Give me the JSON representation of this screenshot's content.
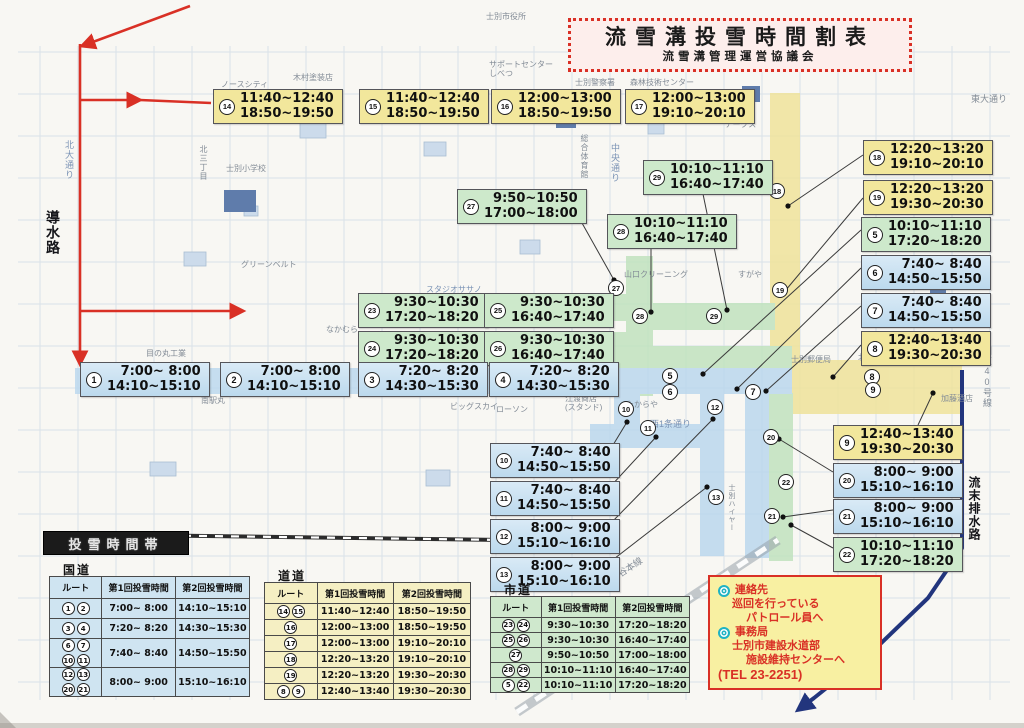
{
  "title": {
    "main": "流雪溝投雪時間割表",
    "sub": "流雪溝管理運営協議会"
  },
  "section_header": "投雪時間帯",
  "colors": {
    "yellow": "#f2e79c",
    "blue": "#bcd9ed",
    "green": "#cde9cb",
    "red_route": "#d93025",
    "river": "#22357d"
  },
  "time_labels": [
    {
      "num": 14,
      "color": "yellow",
      "x": 213,
      "y": 89,
      "t1": "11:40~12:40",
      "t2": "18:50~19:50"
    },
    {
      "num": 15,
      "color": "yellow",
      "x": 359,
      "y": 89,
      "t1": "11:40~12:40",
      "t2": "18:50~19:50"
    },
    {
      "num": 16,
      "color": "yellow",
      "x": 491,
      "y": 89,
      "t1": "12:00~13:00",
      "t2": "18:50~19:50"
    },
    {
      "num": 17,
      "color": "yellow",
      "x": 625,
      "y": 89,
      "t1": "12:00~13:00",
      "t2": "19:10~20:10"
    },
    {
      "num": 29,
      "color": "green",
      "x": 643,
      "y": 160,
      "t1": "10:10~11:10",
      "t2": "16:40~17:40"
    },
    {
      "num": 27,
      "color": "green",
      "x": 457,
      "y": 189,
      "t1": "9:50~10:50",
      "t2": "17:00~18:00"
    },
    {
      "num": 28,
      "color": "green",
      "x": 607,
      "y": 214,
      "t1": "10:10~11:10",
      "t2": "16:40~17:40"
    },
    {
      "num": 18,
      "color": "yellow",
      "x": 863,
      "y": 140,
      "t1": "12:20~13:20",
      "t2": "19:10~20:10"
    },
    {
      "num": 19,
      "color": "yellow",
      "x": 863,
      "y": 180,
      "t1": "12:20~13:20",
      "t2": "19:30~20:30"
    },
    {
      "num": 5,
      "color": "green",
      "x": 861,
      "y": 217,
      "t1": "10:10~11:10",
      "t2": "17:20~18:20"
    },
    {
      "num": 6,
      "color": "blue",
      "x": 861,
      "y": 255,
      "t1": "7:40~ 8:40",
      "t2": "14:50~15:50"
    },
    {
      "num": 7,
      "color": "blue",
      "x": 861,
      "y": 293,
      "t1": "7:40~ 8:40",
      "t2": "14:50~15:50"
    },
    {
      "num": 8,
      "color": "yellow",
      "x": 861,
      "y": 331,
      "t1": "12:40~13:40",
      "t2": "19:30~20:30"
    },
    {
      "num": 23,
      "color": "green",
      "x": 358,
      "y": 293,
      "t1": "9:30~10:30",
      "t2": "17:20~18:20"
    },
    {
      "num": 25,
      "color": "green",
      "x": 484,
      "y": 293,
      "t1": "9:30~10:30",
      "t2": "16:40~17:40"
    },
    {
      "num": 24,
      "color": "green",
      "x": 358,
      "y": 331,
      "t1": "9:30~10:30",
      "t2": "17:20~18:20"
    },
    {
      "num": 26,
      "color": "green",
      "x": 484,
      "y": 331,
      "t1": "9:30~10:30",
      "t2": "16:40~17:40"
    },
    {
      "num": 1,
      "color": "blue",
      "x": 80,
      "y": 362,
      "t1": "7:00~ 8:00",
      "t2": "14:10~15:10"
    },
    {
      "num": 2,
      "color": "blue",
      "x": 220,
      "y": 362,
      "t1": "7:00~ 8:00",
      "t2": "14:10~15:10"
    },
    {
      "num": 3,
      "color": "blue",
      "x": 358,
      "y": 362,
      "t1": "7:20~ 8:20",
      "t2": "14:30~15:30"
    },
    {
      "num": 4,
      "color": "blue",
      "x": 489,
      "y": 362,
      "t1": "7:20~ 8:20",
      "t2": "14:30~15:30"
    },
    {
      "num": 10,
      "color": "blue",
      "x": 490,
      "y": 443,
      "t1": "7:40~ 8:40",
      "t2": "14:50~15:50"
    },
    {
      "num": 11,
      "color": "blue",
      "x": 490,
      "y": 481,
      "t1": "7:40~ 8:40",
      "t2": "14:50~15:50"
    },
    {
      "num": 12,
      "color": "blue",
      "x": 490,
      "y": 519,
      "t1": "8:00~ 9:00",
      "t2": "15:10~16:10"
    },
    {
      "num": 13,
      "color": "blue",
      "x": 490,
      "y": 557,
      "t1": "8:00~ 9:00",
      "t2": "15:10~16:10"
    },
    {
      "num": 9,
      "color": "yellow",
      "x": 833,
      "y": 425,
      "t1": "12:40~13:40",
      "t2": "19:30~20:30"
    },
    {
      "num": 20,
      "color": "blue",
      "x": 833,
      "y": 463,
      "t1": "8:00~ 9:00",
      "t2": "15:10~16:10"
    },
    {
      "num": 21,
      "color": "blue",
      "x": 833,
      "y": 499,
      "t1": "8:00~ 9:00",
      "t2": "15:10~16:10"
    },
    {
      "num": 22,
      "color": "green",
      "x": 833,
      "y": 537,
      "t1": "10:10~11:10",
      "t2": "17:20~18:20"
    }
  ],
  "route_markers": [
    {
      "num": 18,
      "x": 777,
      "y": 191
    },
    {
      "num": 19,
      "x": 780,
      "y": 290
    },
    {
      "num": 27,
      "x": 616,
      "y": 288
    },
    {
      "num": 28,
      "x": 640,
      "y": 316
    },
    {
      "num": 29,
      "x": 714,
      "y": 316
    },
    {
      "num": 5,
      "x": 670,
      "y": 376
    },
    {
      "num": 6,
      "x": 670,
      "y": 392
    },
    {
      "num": 7,
      "x": 753,
      "y": 392
    },
    {
      "num": 10,
      "x": 626,
      "y": 409
    },
    {
      "num": 11,
      "x": 648,
      "y": 428
    },
    {
      "num": 12,
      "x": 715,
      "y": 407
    },
    {
      "num": 13,
      "x": 716,
      "y": 497
    },
    {
      "num": 20,
      "x": 771,
      "y": 437
    },
    {
      "num": 21,
      "x": 772,
      "y": 516
    },
    {
      "num": 22,
      "x": 786,
      "y": 482
    },
    {
      "num": 8,
      "x": 872,
      "y": 377
    },
    {
      "num": 9,
      "x": 873,
      "y": 390
    }
  ],
  "leader_lines": [
    {
      "x1": 863,
      "y1": 155,
      "x2": 788,
      "y2": 206
    },
    {
      "x1": 863,
      "y1": 198,
      "x2": 785,
      "y2": 291
    },
    {
      "x1": 573,
      "y1": 207,
      "x2": 614,
      "y2": 280
    },
    {
      "x1": 651,
      "y1": 246,
      "x2": 651,
      "y2": 312
    },
    {
      "x1": 703,
      "y1": 194,
      "x2": 727,
      "y2": 310
    },
    {
      "x1": 861,
      "y1": 230,
      "x2": 703,
      "y2": 374
    },
    {
      "x1": 861,
      "y1": 268,
      "x2": 737,
      "y2": 389
    },
    {
      "x1": 861,
      "y1": 306,
      "x2": 766,
      "y2": 391
    },
    {
      "x1": 861,
      "y1": 345,
      "x2": 833,
      "y2": 377
    },
    {
      "x1": 918,
      "y1": 425,
      "x2": 933,
      "y2": 393
    },
    {
      "x1": 833,
      "y1": 472,
      "x2": 779,
      "y2": 439
    },
    {
      "x1": 833,
      "y1": 510,
      "x2": 783,
      "y2": 517
    },
    {
      "x1": 833,
      "y1": 548,
      "x2": 791,
      "y2": 525
    },
    {
      "x1": 610,
      "y1": 450,
      "x2": 627,
      "y2": 422
    },
    {
      "x1": 610,
      "y1": 487,
      "x2": 656,
      "y2": 437
    },
    {
      "x1": 610,
      "y1": 524,
      "x2": 713,
      "y2": 419
    },
    {
      "x1": 610,
      "y1": 562,
      "x2": 707,
      "y2": 487
    }
  ],
  "map_texts": [
    {
      "t": "ノースシティ",
      "x": 221,
      "y": 80
    },
    {
      "t": "木村塗装店",
      "x": 293,
      "y": 73
    },
    {
      "t": "サポートセンター\nしべつ",
      "x": 489,
      "y": 60
    },
    {
      "t": "士別市役所",
      "x": 486,
      "y": 12
    },
    {
      "t": "士別警察署",
      "x": 575,
      "y": 78
    },
    {
      "t": "森林技術センター",
      "x": 630,
      "y": 78
    },
    {
      "t": "東大通り",
      "x": 971,
      "y": 95,
      "size": 9
    },
    {
      "t": "アークス",
      "x": 725,
      "y": 120
    },
    {
      "t": "中央通り",
      "x": 610,
      "y": 143,
      "vert": true,
      "blue": true,
      "size": 9
    },
    {
      "t": "総合体育館",
      "x": 580,
      "y": 134,
      "vert": true
    },
    {
      "t": "士別小学校",
      "x": 226,
      "y": 164
    },
    {
      "t": "北大通り",
      "x": 64,
      "y": 140,
      "vert": true,
      "blue": true,
      "size": 9
    },
    {
      "t": "北三丁目",
      "x": 199,
      "y": 145,
      "vert": true
    },
    {
      "t": "導水路",
      "x": 48,
      "y": 210,
      "vert": true,
      "dark": true,
      "size": 14
    },
    {
      "t": "グリーンベルト",
      "x": 241,
      "y": 260
    },
    {
      "t": "スタジオササノ",
      "x": 426,
      "y": 285,
      "blue": true
    },
    {
      "t": "なかむら",
      "x": 326,
      "y": 325
    },
    {
      "t": "目の丸工業",
      "x": 146,
      "y": 349
    },
    {
      "t": "南駅丸",
      "x": 201,
      "y": 396
    },
    {
      "t": "ビッグスカイ",
      "x": 450,
      "y": 402
    },
    {
      "t": "ローソン",
      "x": 496,
      "y": 405
    },
    {
      "t": "江渡商店\n(スタンド)",
      "x": 565,
      "y": 394
    },
    {
      "t": "たからや",
      "x": 626,
      "y": 400
    },
    {
      "t": "西1条通り",
      "x": 650,
      "y": 420,
      "blue": true,
      "size": 9
    },
    {
      "t": "北星信金",
      "x": 576,
      "y": 355
    },
    {
      "t": "山口クリーニング",
      "x": 624,
      "y": 270
    },
    {
      "t": "すがや",
      "x": 738,
      "y": 270
    },
    {
      "t": "士別郵便局",
      "x": 791,
      "y": 355
    },
    {
      "t": "北洋銀行",
      "x": 858,
      "y": 353
    },
    {
      "t": "国道40号線",
      "x": 982,
      "y": 346,
      "vert": true,
      "size": 9
    },
    {
      "t": "加藤酒店",
      "x": 941,
      "y": 394
    },
    {
      "t": "流末排水路",
      "x": 969,
      "y": 476,
      "vert": true,
      "dark": true,
      "size": 12
    },
    {
      "t": "士別ハイヤー",
      "x": 727,
      "y": 484,
      "vert": true,
      "size": 7
    },
    {
      "t": "JR宗谷本線",
      "x": 600,
      "y": 582,
      "rot": -33,
      "size": 9
    }
  ],
  "tables": [
    {
      "id": "kokudo",
      "title": "国道",
      "theme": "blue",
      "x": 49,
      "y": 576,
      "w": 201,
      "col_w": [
        52,
        74,
        75
      ],
      "hdr_h": 21,
      "header": [
        "ルート",
        "第1回投雪時間",
        "第2回投雪時間"
      ],
      "rows": [
        {
          "routes": [
            1,
            2
          ],
          "t1": "7:00~ 8:00",
          "t2": "14:10~15:10",
          "h": 19
        },
        {
          "routes": [
            3,
            4
          ],
          "t1": "7:20~ 8:20",
          "t2": "14:30~15:30",
          "h": 19
        },
        {
          "routes": [
            6,
            7,
            10,
            11
          ],
          "t1": "7:40~ 8:40",
          "t2": "14:50~15:50",
          "h": 28
        },
        {
          "routes": [
            12,
            13,
            20,
            21
          ],
          "t1": "8:00~ 9:00",
          "t2": "15:10~16:10",
          "h": 28
        }
      ]
    },
    {
      "id": "dodo",
      "title": "道道",
      "theme": "yellow",
      "x": 264,
      "y": 582,
      "w": 207,
      "col_w": [
        52,
        77,
        78
      ],
      "hdr_h": 20,
      "header": [
        "ルート",
        "第1回投雪時間",
        "第2回投雪時間"
      ],
      "rows": [
        {
          "routes": [
            14,
            15
          ],
          "t1": "11:40~12:40",
          "t2": "18:50~19:50",
          "h": 15
        },
        {
          "routes": [
            16
          ],
          "t1": "12:00~13:00",
          "t2": "18:50~19:50",
          "h": 15
        },
        {
          "routes": [
            17
          ],
          "t1": "12:00~13:00",
          "t2": "19:10~20:10",
          "h": 15
        },
        {
          "routes": [
            18
          ],
          "t1": "12:20~13:20",
          "t2": "19:10~20:10",
          "h": 15
        },
        {
          "routes": [
            19
          ],
          "t1": "12:20~13:20",
          "t2": "19:30~20:30",
          "h": 15
        },
        {
          "routes": [
            8,
            9
          ],
          "t1": "12:40~13:40",
          "t2": "19:30~20:30",
          "h": 15
        }
      ]
    },
    {
      "id": "shido",
      "title": "市道",
      "theme": "green",
      "x": 490,
      "y": 596,
      "w": 200,
      "col_w": [
        50,
        75,
        75
      ],
      "hdr_h": 20,
      "header": [
        "ルート",
        "第1回投雪時間",
        "第2回投雪時間"
      ],
      "rows": [
        {
          "routes": [
            23,
            24
          ],
          "t1": "9:30~10:30",
          "t2": "17:20~18:20",
          "h": 14
        },
        {
          "routes": [
            25,
            26
          ],
          "t1": "9:30~10:30",
          "t2": "16:40~17:40",
          "h": 14
        },
        {
          "routes": [
            27
          ],
          "t1": "9:50~10:50",
          "t2": "17:00~18:00",
          "h": 14
        },
        {
          "routes": [
            28,
            29
          ],
          "t1": "10:10~11:10",
          "t2": "16:40~17:40",
          "h": 14
        },
        {
          "routes": [
            5,
            22
          ],
          "t1": "10:10~11:10",
          "t2": "17:20~18:20",
          "h": 14
        }
      ]
    }
  ],
  "contact": {
    "lines": [
      {
        "bullet": true,
        "indent": 0,
        "text": "連絡先"
      },
      {
        "bullet": false,
        "indent": 1,
        "text": "巡回を行っている"
      },
      {
        "bullet": false,
        "indent": 2,
        "text": "パトロール員へ"
      },
      {
        "bullet": true,
        "indent": 0,
        "text": "事務局"
      },
      {
        "bullet": false,
        "indent": 1,
        "text": "士別市建設水道部"
      },
      {
        "bullet": false,
        "indent": 2,
        "text": "施設維持センターへ"
      },
      {
        "bullet": false,
        "indent": 0,
        "text": "(TEL 23-2251)",
        "tel": true
      }
    ]
  }
}
